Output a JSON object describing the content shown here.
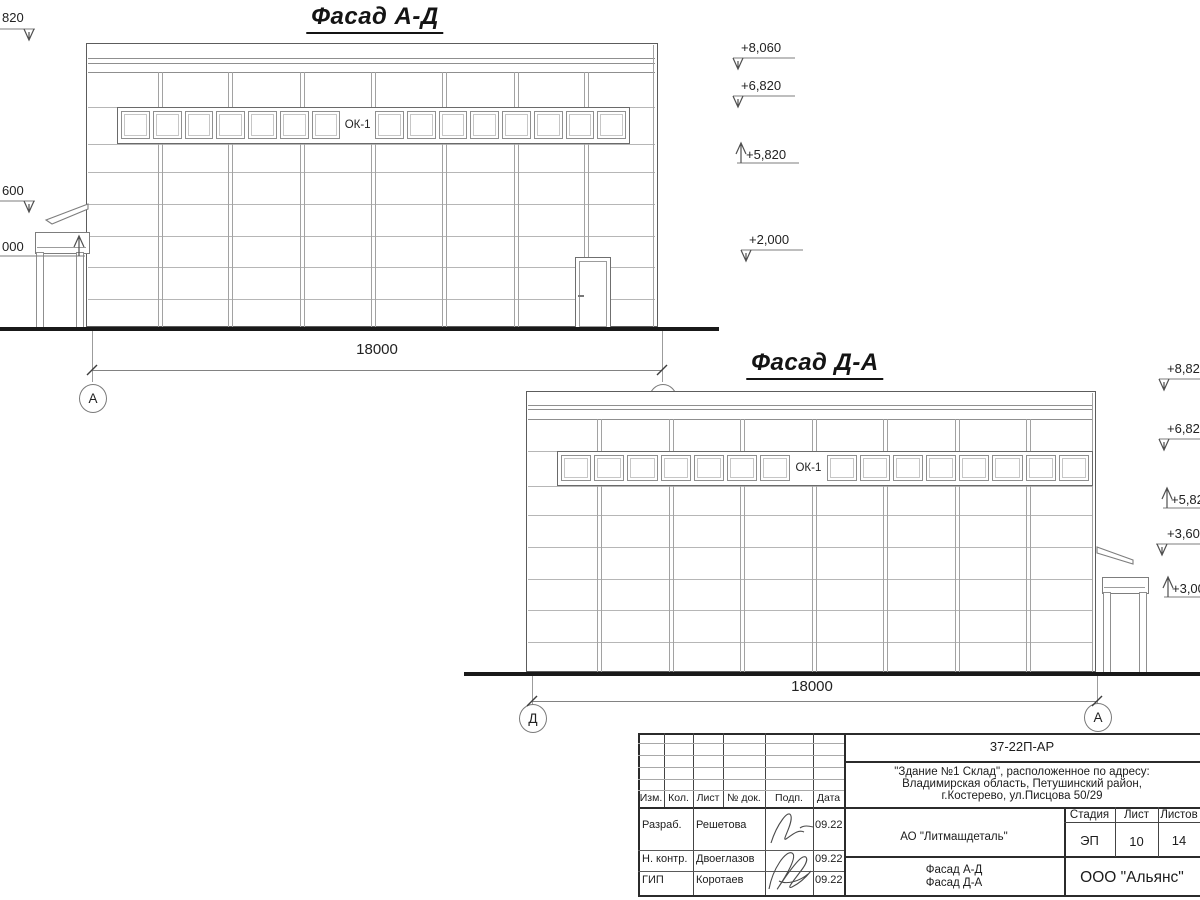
{
  "facades": [
    {
      "title": "Фасад А-Д",
      "title_cx": 375,
      "title_top": 3,
      "bld": {
        "x": 86,
        "y": 43,
        "w": 573,
        "h": 284
      },
      "parapet": [
        58,
        63,
        72
      ],
      "joints": [
        107,
        144,
        172,
        204,
        236,
        267,
        299
      ],
      "cols": [
        160,
        230,
        302,
        373,
        444,
        516,
        586
      ],
      "inner_edge": 653,
      "band": {
        "x": 117,
        "y": 107,
        "w": 513,
        "h": 37,
        "cells": 16,
        "label_cell": 7,
        "label": "ОК-1"
      },
      "door": {
        "x": 575,
        "y": 257,
        "w": 37,
        "h": 70
      },
      "annex": {
        "side": "left",
        "band": [
          35,
          232,
          53,
          20
        ],
        "posts": [
          [
            36,
            6
          ],
          [
            76,
            6
          ]
        ],
        "posts_y": [
          252,
          327
        ],
        "roof": [
          [
            88,
            204
          ],
          [
            46,
            220
          ],
          [
            52,
            224
          ],
          [
            88,
            209
          ]
        ]
      },
      "ground": {
        "x": 0,
        "y": 327,
        "w": 719,
        "h": 4
      },
      "dim": {
        "y": 370,
        "x1": 92,
        "x2": 662,
        "label": "18000",
        "label_cx": 377,
        "label_top": 341,
        "ext_y1": 331,
        "ext_y2": 382
      },
      "bubbles": [
        {
          "t": "А",
          "cx": 92,
          "cy": 397
        },
        {
          "t": "Д",
          "cx": 662,
          "cy": 397
        }
      ],
      "elev": [
        {
          "t": "+8,060",
          "tx": 741,
          "ty": 40,
          "l": [
            733,
            795
          ],
          "ly": 58,
          "ax": 738,
          "dir": "down"
        },
        {
          "t": "+6,820",
          "tx": 741,
          "ty": 78,
          "l": [
            733,
            795
          ],
          "ly": 96,
          "ax": 738,
          "dir": "down"
        },
        {
          "t": "+5,820",
          "tx": 746,
          "ty": 147,
          "l": [
            737,
            799
          ],
          "ly": 163,
          "ax": 741,
          "dir": "up"
        },
        {
          "t": "+2,000",
          "tx": 749,
          "ty": 232,
          "l": [
            741,
            803
          ],
          "ly": 250,
          "ax": 746,
          "dir": "down"
        },
        {
          "t": "820",
          "tx": 2,
          "ty": 10,
          "l": [
            0,
            35
          ],
          "ly": 29,
          "ax": 29,
          "dir": "down"
        },
        {
          "t": "600",
          "tx": 2,
          "ty": 183,
          "l": [
            0,
            35
          ],
          "ly": 201,
          "ax": 29,
          "dir": "down"
        },
        {
          "t": "000",
          "tx": 2,
          "ty": 239,
          "l": [
            0,
            85
          ],
          "ly": 256,
          "ax": 79,
          "dir": "up"
        }
      ]
    },
    {
      "title": "Фасад Д-А",
      "title_cx": 815,
      "title_top": 349,
      "bld": {
        "x": 526,
        "y": 391,
        "w": 571,
        "h": 281
      },
      "parapet": [
        405,
        409,
        419
      ],
      "joints": [
        451,
        486,
        515,
        547,
        579,
        610,
        642
      ],
      "cols": [
        599,
        671,
        742,
        814,
        885,
        957,
        1028
      ],
      "inner_edge": 1092,
      "band": {
        "x": 557,
        "y": 451,
        "w": 536,
        "h": 35,
        "cells": 16,
        "label_cell": 7,
        "label": "ОК-1"
      },
      "door": null,
      "annex": {
        "side": "right",
        "band": [
          1102,
          577,
          45,
          15
        ],
        "posts": [
          [
            1103,
            6
          ],
          [
            1139,
            6
          ]
        ],
        "posts_y": [
          592,
          672
        ],
        "roof": [
          [
            1097,
            547
          ],
          [
            1133,
            560
          ],
          [
            1133,
            564
          ],
          [
            1097,
            553
          ]
        ]
      },
      "ground": {
        "x": 464,
        "y": 672,
        "w": 736,
        "h": 4
      },
      "dim": {
        "y": 701,
        "x1": 532,
        "x2": 1097,
        "label": "18000",
        "label_cx": 812,
        "label_top": 678,
        "ext_y1": 676,
        "ext_y2": 712
      },
      "bubbles": [
        {
          "t": "Д",
          "cx": 532,
          "cy": 717
        },
        {
          "t": "А",
          "cx": 1097,
          "cy": 716
        }
      ],
      "elev": [
        {
          "t": "+8,82",
          "tx": 1167,
          "ty": 361,
          "l": [
            1159,
            1200
          ],
          "ly": 379,
          "ax": 1164,
          "dir": "down"
        },
        {
          "t": "+6,82",
          "tx": 1167,
          "ty": 421,
          "l": [
            1159,
            1200
          ],
          "ly": 439,
          "ax": 1164,
          "dir": "down"
        },
        {
          "t": "+5,82",
          "tx": 1171,
          "ty": 492,
          "l": [
            1163,
            1200
          ],
          "ly": 508,
          "ax": 1167,
          "dir": "up"
        },
        {
          "t": "+3,60",
          "tx": 1167,
          "ty": 526,
          "l": [
            1156,
            1200
          ],
          "ly": 544,
          "ax": 1162,
          "dir": "down"
        },
        {
          "t": "+3,00",
          "tx": 1172,
          "ty": 581,
          "l": [
            1164,
            1200
          ],
          "ly": 597,
          "ax": 1168,
          "dir": "up"
        }
      ]
    }
  ],
  "title_block": {
    "code": "37-22П-АР",
    "address_lines": [
      "\"Здание №1 Склад\", расположенное по адресу:",
      "Владимирская область, Петушинский район,",
      "г.Костерево, ул.Писцова 50/29"
    ],
    "customer": "АО \"Литмашдеталь\"",
    "sheet_titles": [
      "Фасад А-Д",
      "Фасад Д-А"
    ],
    "firm": "ООО \"Альянс\"",
    "stage_label": "Стадия",
    "sheet_label": "Лист",
    "sheets_label": "Листов",
    "stage": "ЭП",
    "sheet": "10",
    "sheets": "14",
    "header_cols": [
      "Изм.",
      "Кол.",
      "Лист",
      "№ док.",
      "Подп.",
      "Дата"
    ],
    "sign_rows": [
      {
        "role": "Разраб.",
        "name": "Решетова",
        "date": "09.22"
      },
      {
        "role": "Н. контр.",
        "name": "Двоеглазов",
        "date": "09.22"
      },
      {
        "role": "ГИП",
        "name": "Коротаев",
        "date": "09.22"
      }
    ]
  }
}
